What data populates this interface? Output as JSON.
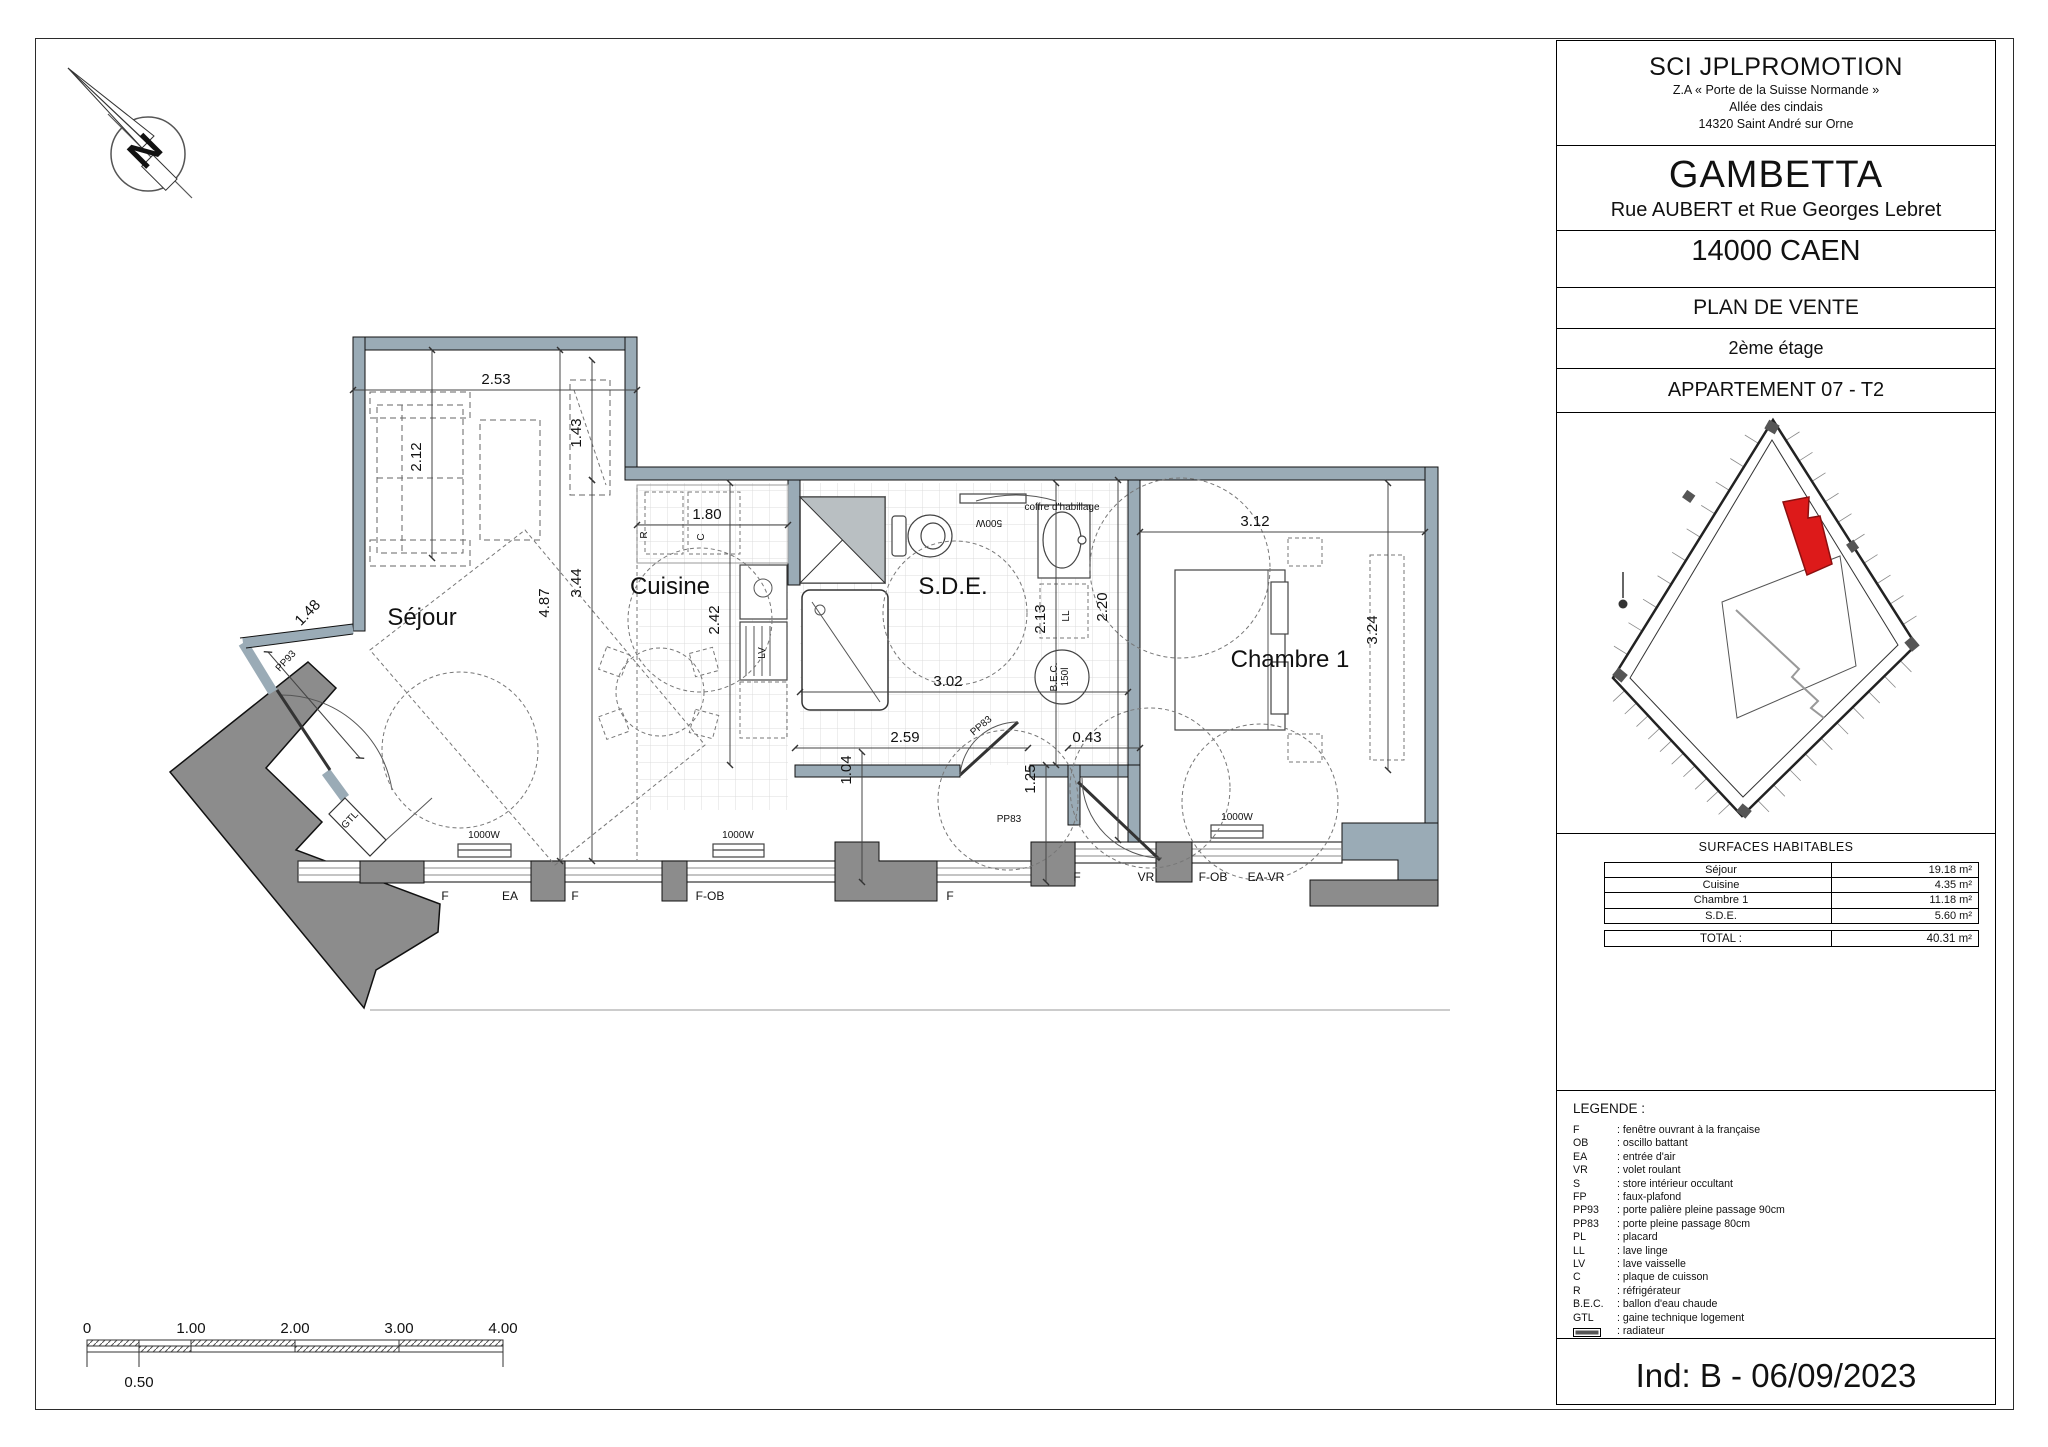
{
  "colors": {
    "wall": "#9aabb6",
    "dark": "#8c8c8c",
    "duct": "#b9bfc2",
    "red": "#dd1a1a",
    "tile": "#dcdcdc"
  },
  "north": {
    "label": "N"
  },
  "title_block": {
    "company": "SCI JPLPROMOTION",
    "address_lines": [
      "Z.A « Porte de la Suisse Normande »",
      "Allée des cindais",
      "14320 Saint André sur Orne"
    ],
    "project": "GAMBETTA",
    "street": "Rue AUBERT et Rue Georges Lebret",
    "city": "14000 CAEN",
    "doc_type": "PLAN DE VENTE",
    "floor": "2ème étage",
    "apartment": "APPARTEMENT 07 - T2",
    "revision": "Ind: B - 06/09/2023"
  },
  "surfaces": {
    "header": "SURFACES HABITABLES",
    "rows": [
      {
        "label": "Séjour",
        "value": "19.18 m²"
      },
      {
        "label": "Cuisine",
        "value": "4.35 m²"
      },
      {
        "label": "Chambre 1",
        "value": "11.18 m²"
      },
      {
        "label": "S.D.E.",
        "value": "5.60 m²"
      }
    ],
    "total": {
      "label": "TOTAL :",
      "value": "40.31 m²"
    }
  },
  "legend": {
    "title": "LEGENDE :",
    "entries": [
      {
        "abbr": "F",
        "desc": ": fenêtre ouvrant à la française"
      },
      {
        "abbr": "OB",
        "desc": ": oscillo battant"
      },
      {
        "abbr": "EA",
        "desc": ": entrée d'air"
      },
      {
        "abbr": "VR",
        "desc": ": volet roulant"
      },
      {
        "abbr": "S",
        "desc": ": store intérieur occultant"
      },
      {
        "abbr": "FP",
        "desc": ": faux-plafond"
      },
      {
        "abbr": "PP93",
        "desc": ": porte palière pleine passage 90cm"
      },
      {
        "abbr": "PP83",
        "desc": ": porte pleine passage 80cm"
      },
      {
        "abbr": "PL",
        "desc": ": placard"
      },
      {
        "abbr": "LL",
        "desc": ": lave linge"
      },
      {
        "abbr": "LV",
        "desc": ": lave vaisselle"
      },
      {
        "abbr": "C",
        "desc": ": plaque de cuisson"
      },
      {
        "abbr": "R",
        "desc": ": réfrigérateur"
      },
      {
        "abbr": "B.E.C.",
        "desc": ": ballon d'eau chaude"
      },
      {
        "abbr": "GTL",
        "desc": ": gaine technique logement"
      },
      {
        "abbr": "",
        "symbol": "radiator",
        "desc": ": radiateur"
      }
    ]
  },
  "scale_bar": {
    "ticks": [
      {
        "label": "0",
        "m": 0
      },
      {
        "label": "1.00",
        "m": 1
      },
      {
        "label": "2.00",
        "m": 2
      },
      {
        "label": "3.00",
        "m": 3
      },
      {
        "label": "4.00",
        "m": 4
      }
    ],
    "half": {
      "label": "0.50",
      "m": 0.5
    }
  },
  "plan": {
    "rooms": [
      {
        "t": "Séjour",
        "x": 282,
        "y": 305,
        "s": 24
      },
      {
        "t": "Cuisine",
        "x": 530,
        "y": 274,
        "s": 22
      },
      {
        "t": "S.D.E.",
        "x": 813,
        "y": 274,
        "s": 24
      },
      {
        "t": "Chambre 1",
        "x": 1150,
        "y": 347,
        "s": 22
      }
    ],
    "dims": [
      {
        "t": "2.53",
        "x": 356,
        "y": 64
      },
      {
        "t": "2.12",
        "x": 281,
        "y": 137,
        "r": -90
      },
      {
        "t": "1.43",
        "x": 441,
        "y": 113,
        "r": -90
      },
      {
        "t": "1.48",
        "x": 171,
        "y": 296,
        "r": -46
      },
      {
        "t": "4.87",
        "x": 409,
        "y": 283,
        "r": -90
      },
      {
        "t": "3.44",
        "x": 441,
        "y": 263,
        "r": -90
      },
      {
        "t": "1.80",
        "x": 567,
        "y": 199
      },
      {
        "t": "2.42",
        "x": 579,
        "y": 300,
        "r": -90
      },
      {
        "t": "3.02",
        "x": 808,
        "y": 366
      },
      {
        "t": "2.13",
        "x": 905,
        "y": 299,
        "r": -90
      },
      {
        "t": "2.20",
        "x": 967,
        "y": 287,
        "r": -90
      },
      {
        "t": "3.12",
        "x": 1115,
        "y": 206
      },
      {
        "t": "3.24",
        "x": 1237,
        "y": 310,
        "r": -90
      },
      {
        "t": "2.59",
        "x": 765,
        "y": 422
      },
      {
        "t": "0.43",
        "x": 947,
        "y": 422
      },
      {
        "t": "1.04",
        "x": 711,
        "y": 450,
        "r": -90
      },
      {
        "t": "1.25",
        "x": 895,
        "y": 459,
        "r": -90
      }
    ],
    "labels": [
      {
        "t": "PP93",
        "x": 148,
        "y": 343,
        "r": -47,
        "s": 12
      },
      {
        "t": "GTL",
        "x": 212,
        "y": 502,
        "r": -47,
        "s": 10
      },
      {
        "t": "PP83",
        "x": 843,
        "y": 408,
        "r": -40,
        "s": 11
      },
      {
        "t": "PP83",
        "x": 869,
        "y": 502,
        "s": 11
      },
      {
        "t": "coffre d'habillage",
        "x": 922,
        "y": 190,
        "s": 9
      },
      {
        "t": "500W",
        "x": 849,
        "y": 200,
        "r": 180,
        "s": 9
      },
      {
        "t": "B.E.C.",
        "x": 917,
        "y": 357,
        "r": -90,
        "s": 8
      },
      {
        "t": "150l",
        "x": 928,
        "y": 357,
        "r": -90,
        "s": 8
      },
      {
        "t": "R",
        "x": 507,
        "y": 215,
        "r": -90,
        "s": 13
      },
      {
        "t": "C",
        "x": 564,
        "y": 217,
        "r": -90,
        "s": 12
      },
      {
        "t": "LV",
        "x": 625,
        "y": 333,
        "r": -90,
        "s": 13
      },
      {
        "t": "LL",
        "x": 929,
        "y": 296,
        "r": -90,
        "s": 13
      },
      {
        "t": "1000W",
        "x": 344,
        "y": 518,
        "s": 10
      },
      {
        "t": "1000W",
        "x": 598,
        "y": 518,
        "s": 10
      },
      {
        "t": "1000W",
        "x": 1097,
        "y": 500,
        "s": 10
      }
    ],
    "windows": [
      {
        "t": "F",
        "x": 305,
        "y": 580
      },
      {
        "t": "EA",
        "x": 370,
        "y": 580
      },
      {
        "t": "F",
        "x": 435,
        "y": 580
      },
      {
        "t": "F-OB",
        "x": 570,
        "y": 580
      },
      {
        "t": "F",
        "x": 810,
        "y": 580
      },
      {
        "t": "F",
        "x": 937,
        "y": 561
      },
      {
        "t": "VR",
        "x": 1006,
        "y": 561
      },
      {
        "t": "F-OB",
        "x": 1073,
        "y": 561
      },
      {
        "t": "EA-VR",
        "x": 1126,
        "y": 561
      }
    ]
  }
}
